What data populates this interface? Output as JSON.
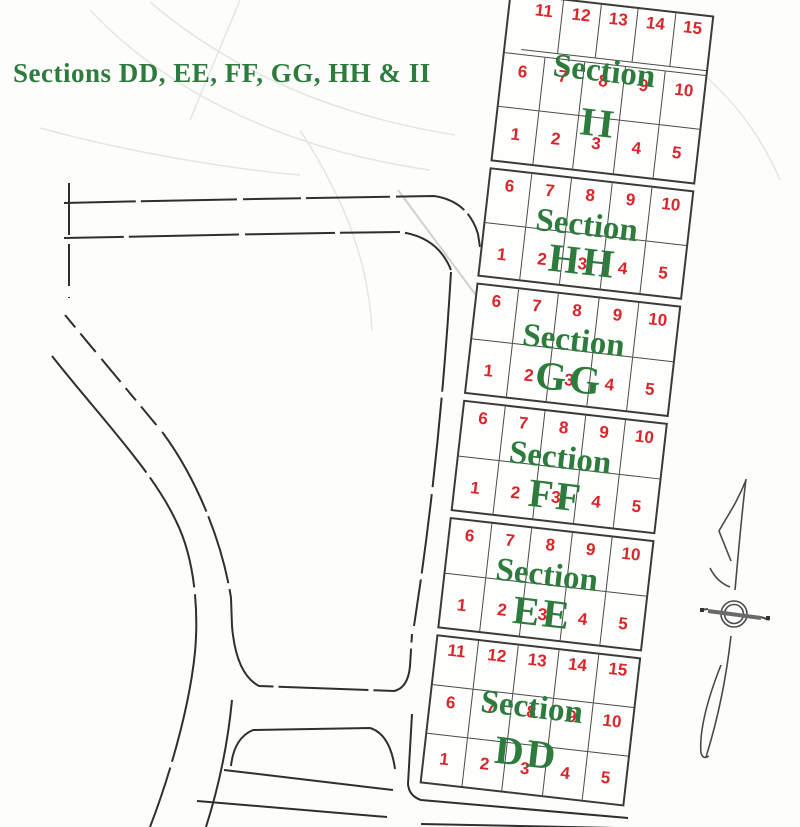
{
  "title": "Sections DD, EE, FF, GG, HH & II",
  "colors": {
    "section_label_green": "#2e7b3e",
    "plot_number_red": "#d8262c",
    "road_line": "#2f2f2f",
    "background": "#fdfdfb"
  },
  "icons": {
    "compass": "compass-rose"
  },
  "sections": [
    {
      "id": "II",
      "label_word": "Section",
      "label_letters": "II",
      "rows": [
        [
          "11",
          "12",
          "13",
          "14",
          "15"
        ],
        [
          "6",
          "7",
          "8",
          "9",
          "10"
        ],
        [
          "1",
          "2",
          "3",
          "4",
          "5"
        ]
      ]
    },
    {
      "id": "HH",
      "label_word": "Section",
      "label_letters": "HH",
      "rows": [
        [
          "6",
          "7",
          "8",
          "9",
          "10"
        ],
        [
          "1",
          "2",
          "3",
          "4",
          "5"
        ]
      ]
    },
    {
      "id": "GG",
      "label_word": "Section",
      "label_letters": "GG",
      "rows": [
        [
          "6",
          "7",
          "8",
          "9",
          "10"
        ],
        [
          "1",
          "2",
          "3",
          "4",
          "5"
        ]
      ]
    },
    {
      "id": "FF",
      "label_word": "Section",
      "label_letters": "FF",
      "rows": [
        [
          "6",
          "7",
          "8",
          "9",
          "10"
        ],
        [
          "1",
          "2",
          "3",
          "4",
          "5"
        ]
      ]
    },
    {
      "id": "EE",
      "label_word": "Section",
      "label_letters": "EE",
      "rows": [
        [
          "6",
          "7",
          "8",
          "9",
          "10"
        ],
        [
          "1",
          "2",
          "3",
          "4",
          "5"
        ]
      ]
    },
    {
      "id": "DD",
      "label_word": "Section",
      "label_letters": "DD",
      "rows": [
        [
          "11",
          "12",
          "13",
          "14",
          "15"
        ],
        [
          "6",
          "7",
          "8",
          "9",
          "10"
        ],
        [
          "1",
          "2",
          "3",
          "4",
          "5"
        ]
      ]
    }
  ]
}
